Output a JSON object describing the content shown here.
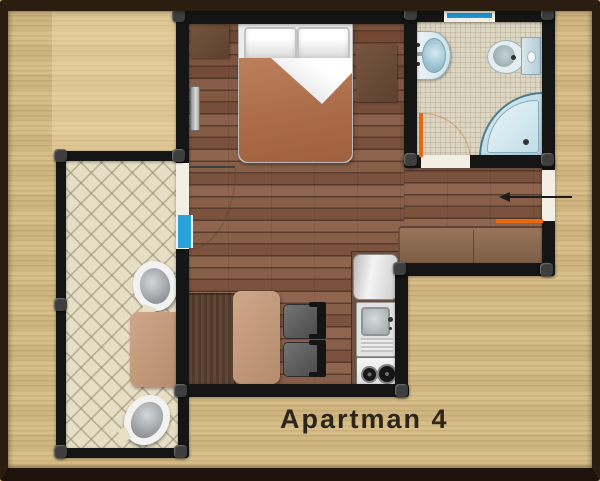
{
  "plan": {
    "caption": "Apartman 4",
    "rooms": [
      "main room with bed, dining and kitchen corner",
      "bathroom",
      "balcony"
    ],
    "furniture": [
      "double bed",
      "two pillows",
      "nightstand left",
      "nightstand right",
      "radiator",
      "bench wardrobe",
      "dining table",
      "dining chair 1",
      "dining chair 2",
      "kitchen counter",
      "refrigerator",
      "kitchen sink",
      "two-burner stove",
      "sofa bench",
      "balcony armchair 1",
      "balcony armchair 2",
      "balcony table",
      "washbasin",
      "toilet",
      "corner shower"
    ],
    "markers": {
      "entrance_arrow": "entrance direction arrow",
      "doors": [
        "entrance door (orange)",
        "bathroom door (orange)",
        "balcony door"
      ],
      "windows": [
        "bathroom window",
        "balcony door glazing"
      ]
    },
    "colors": {
      "background": "#d6bb83",
      "frame": "#2b1c10",
      "walls": "#151515",
      "wood_floor": "#7a523e",
      "balcony_floor": "#e6dfc5",
      "bathroom_floor": "#ddd6c3",
      "blanket": "#b3724e",
      "door_marker_orange": "#e8680f",
      "window_blue": "#1f95d4",
      "fixture_blue": "#a9cfdc",
      "caption_text": "#2d241a"
    }
  }
}
